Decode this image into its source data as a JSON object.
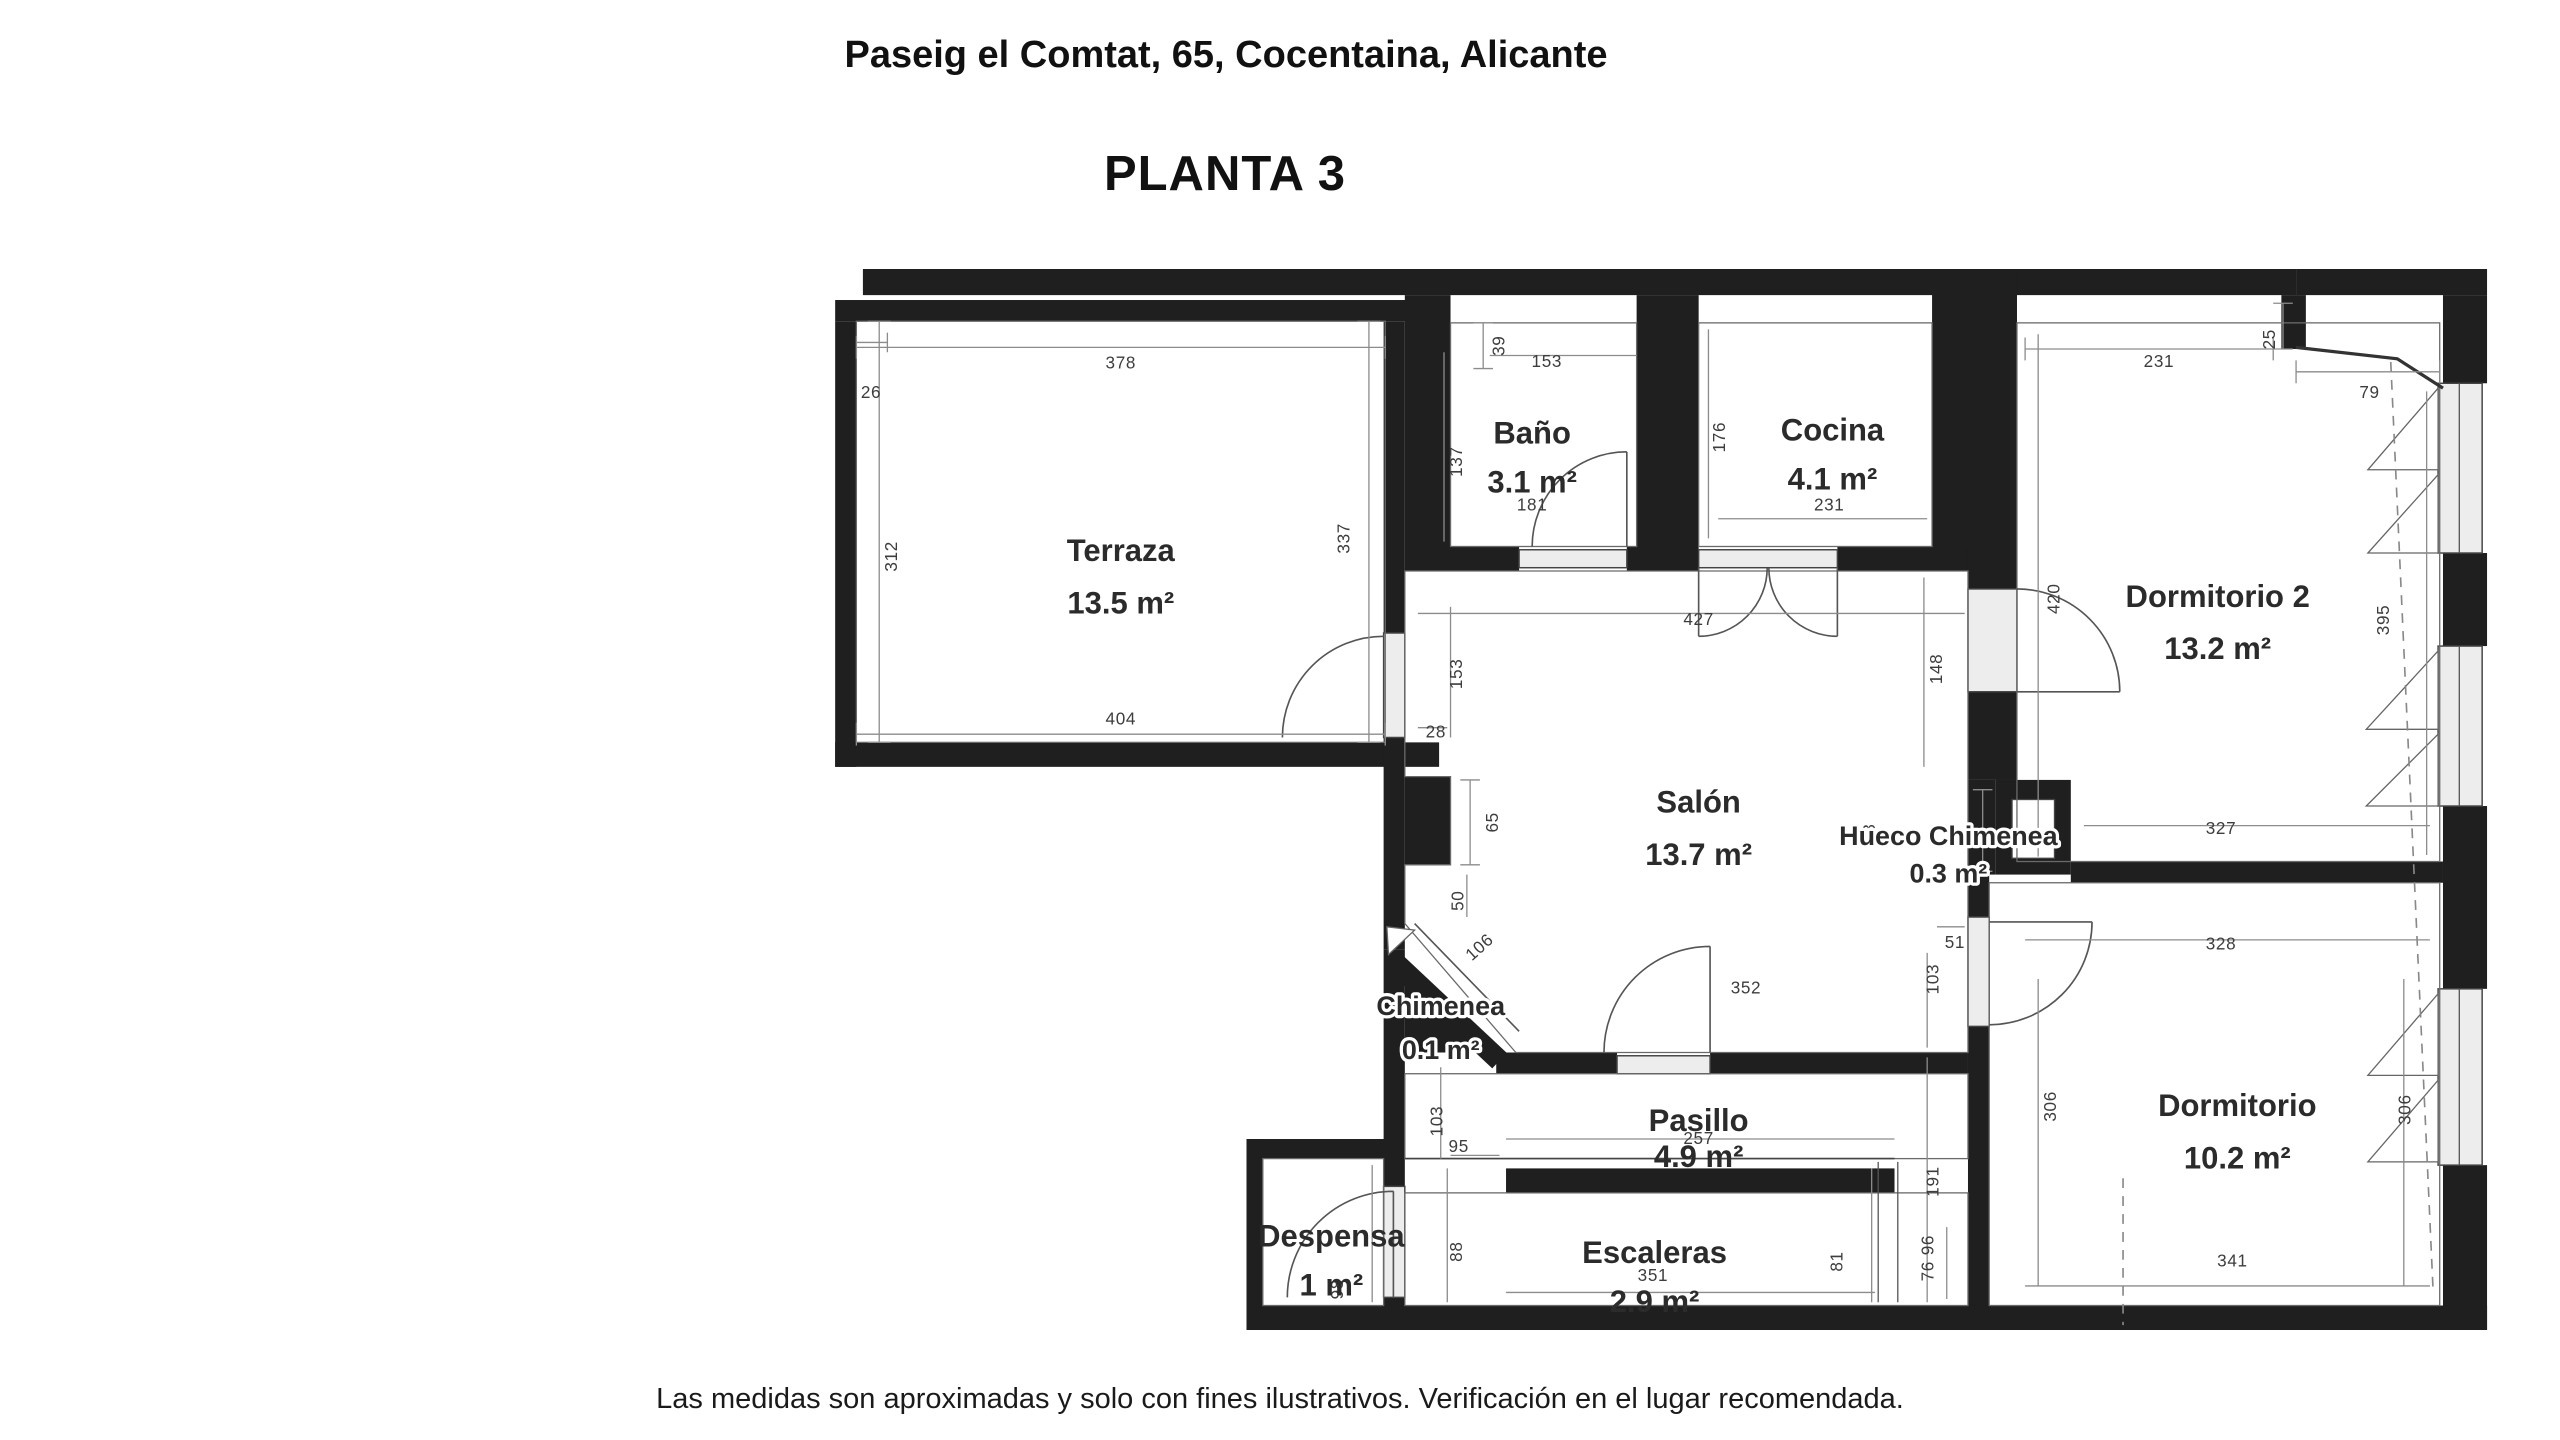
{
  "header": {
    "address": "Paseig el Comtat, 65, Cocentaina, Alicante",
    "floor_label": "PLANTA 3"
  },
  "footer": {
    "disclaimer": "Las medidas son aproximadas y solo con fines ilustrativos. Verificación en el lugar recomendada."
  },
  "colors": {
    "wall": "#1f1f1f",
    "window_fill": "#ededed",
    "line": "#555555",
    "background": "#ffffff"
  },
  "floorplan": {
    "rooms": [
      {
        "name": "Terraza",
        "area": "13.5 m²"
      },
      {
        "name": "Baño",
        "area": "3.1 m²"
      },
      {
        "name": "Cocina",
        "area": "4.1 m²"
      },
      {
        "name": "Dormitorio 2",
        "area": "13.2 m²"
      },
      {
        "name": "Salón",
        "area": "13.7 m²"
      },
      {
        "name": "Hueco Chimenea",
        "area": "0.3 m²"
      },
      {
        "name": "Chimenea",
        "area": "0.1 m²"
      },
      {
        "name": "Pasillo",
        "area": "4.9 m²"
      },
      {
        "name": "Dormitorio",
        "area": "10.2 m²"
      },
      {
        "name": "Despensa",
        "area": "1 m²"
      },
      {
        "name": "Escaleras",
        "area": "2.9 m²"
      }
    ],
    "dimensions_cm": [
      "378",
      "26",
      "312",
      "337",
      "404",
      "39",
      "153",
      "137",
      "181",
      "176",
      "231",
      "231",
      "25",
      "79",
      "420",
      "395",
      "327",
      "427",
      "153",
      "28",
      "65",
      "50",
      "106",
      "148",
      "93",
      "51",
      "103",
      "352",
      "103",
      "95",
      "257",
      "191",
      "98",
      "88",
      "351",
      "81",
      "96",
      "76",
      "328",
      "306",
      "306",
      "341"
    ]
  }
}
